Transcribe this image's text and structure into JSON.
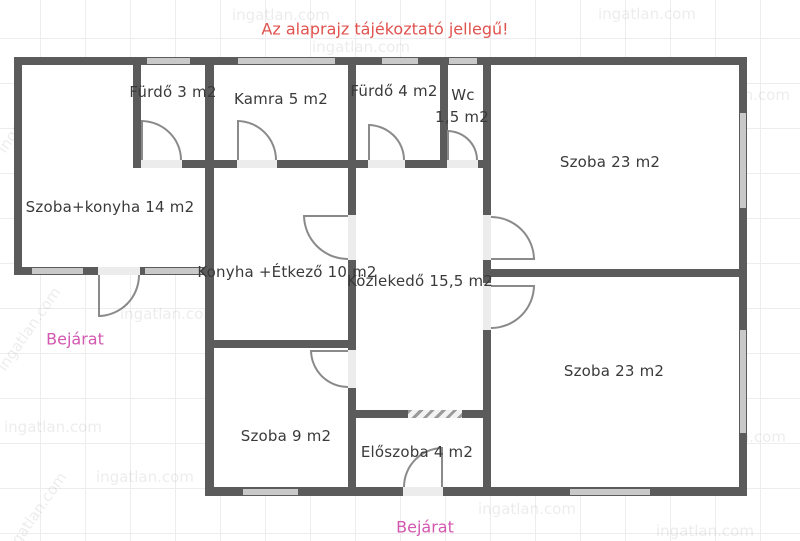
{
  "title": "Az alaprajz tájékoztató jellegű!",
  "watermark": "ingatlan.com",
  "colors": {
    "wall": "#5b5b5b",
    "window": "#c9c9c9",
    "title_red": "#e0524e",
    "entrance_pink": "#d357af",
    "label_gray": "#3a3a3a"
  },
  "rooms": {
    "furdo3": {
      "label": "Fürdő 3 m2"
    },
    "kamra": {
      "label": "Kamra 5 m2"
    },
    "furdo4": {
      "label": "Fürdő 4 m2"
    },
    "wc": {
      "label": "Wc",
      "area": "1,5 m2"
    },
    "szoba23_felso": {
      "label": "Szoba 23 m2"
    },
    "szoba_konyha": {
      "label": "Szoba+konyha 14 m2"
    },
    "konyha_etkezo": {
      "label": "Konyha +Étkező 10 m2"
    },
    "kozlekedo": {
      "label": "Közlekedő 15,5 m2"
    },
    "szoba23_also": {
      "label": "Szoba 23 m2"
    },
    "szoba9": {
      "label": "Szoba 9 m2"
    },
    "eloszoba": {
      "label": "Előszoba 4 m2"
    }
  },
  "entrance_left": {
    "label": "Bejárat"
  },
  "entrance_bottom": {
    "label": "Bejárat"
  }
}
